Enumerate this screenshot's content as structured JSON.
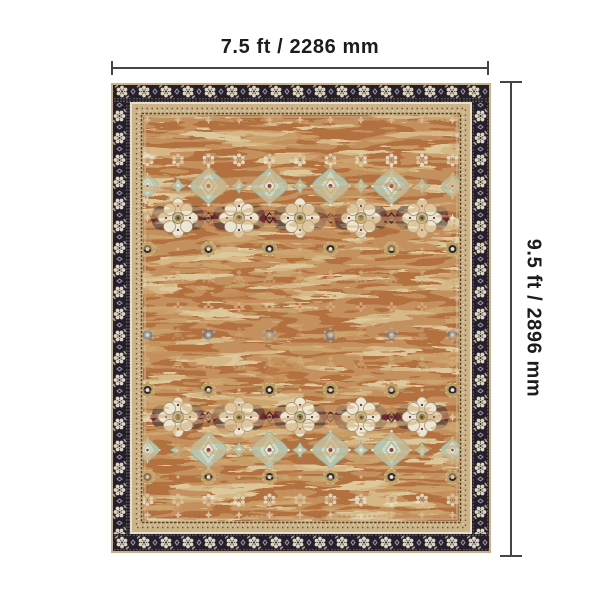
{
  "diagram": {
    "type": "rug-dimension-diagram",
    "width_label": "7.5 ft / 2286 mm",
    "height_label": "9.5 ft / 2896 mm",
    "colors": {
      "background": "#ffffff",
      "dimension_line": "#454545",
      "label_text": "#1c1c1c",
      "rug_border_dark": "#241f29",
      "rug_border_flower": "#ddd4c2",
      "rug_guard_band": "#cdb488",
      "rug_field_rust": "#b3713f",
      "rug_field_tan": "#c89d66",
      "rug_field_beige": "#ddc89c",
      "medallion_cream": "#ece5d2",
      "medallion_red": "#722832",
      "quatrefoil_green": "#b7c7b2",
      "rosette_blue": "#8d9aa8"
    }
  }
}
